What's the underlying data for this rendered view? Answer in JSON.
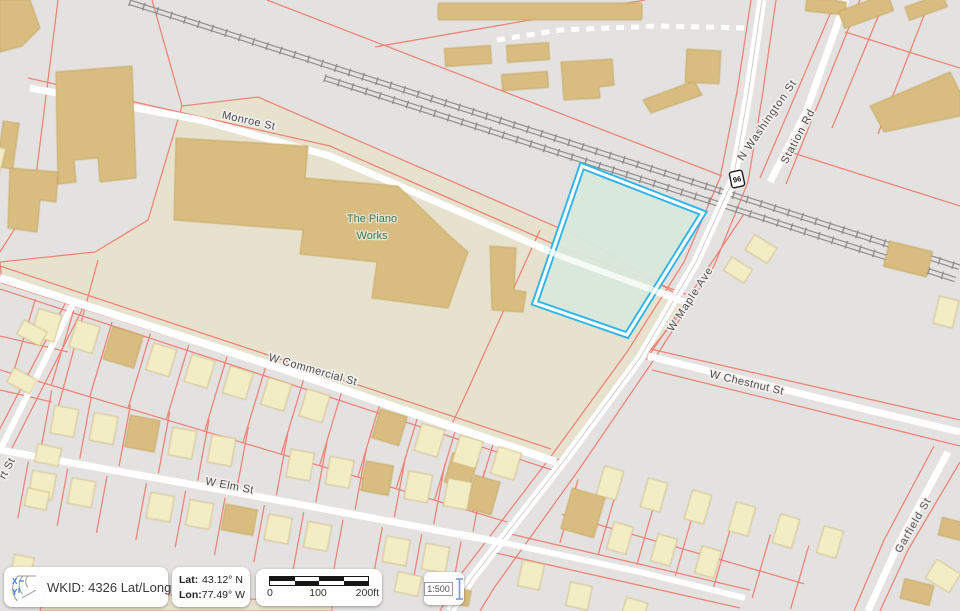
{
  "map": {
    "street_labels": {
      "monroe": "Monroe St",
      "washington": "N Washington St",
      "station": "Station Rd",
      "maple": "W Maple Ave",
      "commercial": "W Commercial St",
      "chestnut": "W Chestnut St",
      "elm": "W Elm St",
      "garfield": "Garfield St",
      "partial_left": "rt St"
    },
    "place_label": {
      "line1": "The Piano",
      "line2": "Works"
    },
    "route_shield_number": "96"
  },
  "status_bar": {
    "wkid_text": "WKID: 4326 Lat/Long",
    "wkid_expander": "▲",
    "lat_label": "Lat:",
    "lat_value": "43.12° N",
    "lon_label": "Lon:",
    "lon_value": "77.49° W",
    "scale_ticks": [
      "0",
      "100",
      "200ft"
    ],
    "scale_ratio": "1:500"
  },
  "colors": {
    "background": "#e3e2e0",
    "land_beige": "#e7e2ce",
    "parcel_line": "#ef8478",
    "building_tan": "#d9bd80",
    "house_yellow": "#f3edc6",
    "road_white": "#ffffff",
    "highlight_stroke": "#2fb4ec",
    "highlight_fill": "#d8e8db",
    "place_label_green": "#3c7a55"
  }
}
